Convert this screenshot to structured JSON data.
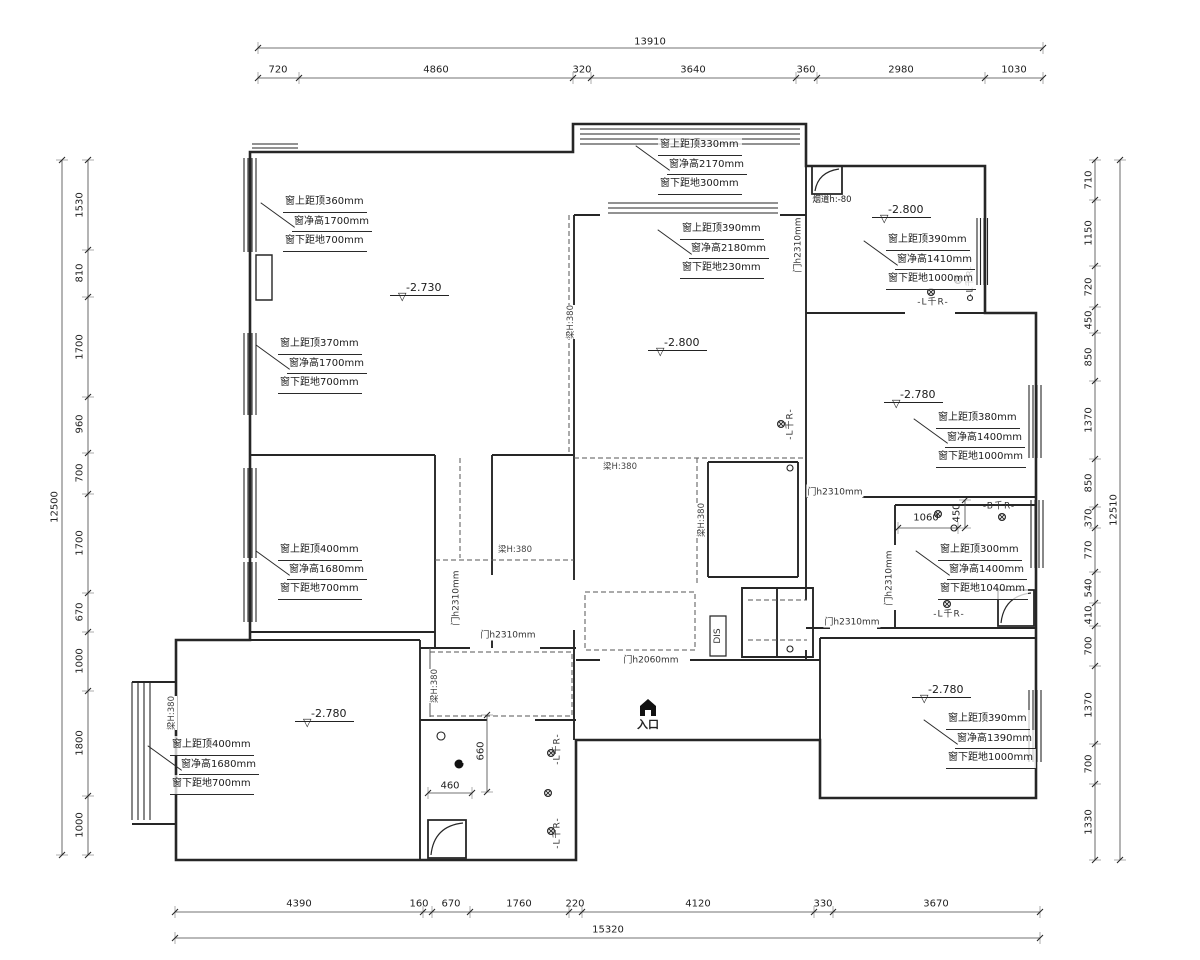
{
  "symbols": {
    "level_triangle": "▽",
    "entrance_label": "入口"
  },
  "labels": [
    {
      "t": "13910",
      "x": 650,
      "y": 42,
      "n": "dim-top-total"
    },
    {
      "t": "720",
      "x": 278,
      "y": 70,
      "n": "dim-top"
    },
    {
      "t": "4860",
      "x": 436,
      "y": 70,
      "n": "dim-top"
    },
    {
      "t": "320",
      "x": 582,
      "y": 70,
      "n": "dim-top"
    },
    {
      "t": "3640",
      "x": 693,
      "y": 70,
      "n": "dim-top"
    },
    {
      "t": "360",
      "x": 806,
      "y": 70,
      "n": "dim-top"
    },
    {
      "t": "2980",
      "x": 901,
      "y": 70,
      "n": "dim-top"
    },
    {
      "t": "1030",
      "x": 1014,
      "y": 70,
      "n": "dim-top"
    },
    {
      "t": "4390",
      "x": 299,
      "y": 904,
      "n": "dim-bottom"
    },
    {
      "t": "160",
      "x": 419,
      "y": 904,
      "n": "dim-bottom"
    },
    {
      "t": "670",
      "x": 451,
      "y": 904,
      "n": "dim-bottom"
    },
    {
      "t": "1760",
      "x": 519,
      "y": 904,
      "n": "dim-bottom"
    },
    {
      "t": "220",
      "x": 575,
      "y": 904,
      "n": "dim-bottom"
    },
    {
      "t": "4120",
      "x": 698,
      "y": 904,
      "n": "dim-bottom"
    },
    {
      "t": "330",
      "x": 823,
      "y": 904,
      "n": "dim-bottom"
    },
    {
      "t": "3670",
      "x": 936,
      "y": 904,
      "n": "dim-bottom"
    },
    {
      "t": "15320",
      "x": 608,
      "y": 930,
      "n": "dim-bottom-total"
    },
    {
      "t": "1530",
      "x": 80,
      "y": 205,
      "r": 1,
      "n": "dim-left"
    },
    {
      "t": "810",
      "x": 80,
      "y": 273,
      "r": 1,
      "n": "dim-left"
    },
    {
      "t": "1700",
      "x": 80,
      "y": 347,
      "r": 1,
      "n": "dim-left"
    },
    {
      "t": "960",
      "x": 80,
      "y": 424,
      "r": 1,
      "n": "dim-left"
    },
    {
      "t": "700",
      "x": 80,
      "y": 473,
      "r": 1,
      "n": "dim-left"
    },
    {
      "t": "1700",
      "x": 80,
      "y": 543,
      "r": 1,
      "n": "dim-left"
    },
    {
      "t": "670",
      "x": 80,
      "y": 612,
      "r": 1,
      "n": "dim-left"
    },
    {
      "t": "1000",
      "x": 80,
      "y": 661,
      "r": 1,
      "n": "dim-left"
    },
    {
      "t": "1800",
      "x": 80,
      "y": 743,
      "r": 1,
      "n": "dim-left"
    },
    {
      "t": "1000",
      "x": 80,
      "y": 825,
      "r": 1,
      "n": "dim-left"
    },
    {
      "t": "12500",
      "x": 55,
      "y": 507,
      "r": 1,
      "n": "dim-left-total"
    },
    {
      "t": "710",
      "x": 1089,
      "y": 180,
      "r": 1,
      "n": "dim-right"
    },
    {
      "t": "1150",
      "x": 1089,
      "y": 233,
      "r": 1,
      "n": "dim-right"
    },
    {
      "t": "720",
      "x": 1089,
      "y": 287,
      "r": 1,
      "n": "dim-right"
    },
    {
      "t": "450",
      "x": 1089,
      "y": 320,
      "r": 1,
      "n": "dim-right"
    },
    {
      "t": "850",
      "x": 1089,
      "y": 357,
      "r": 1,
      "n": "dim-right"
    },
    {
      "t": "1370",
      "x": 1089,
      "y": 420,
      "r": 1,
      "n": "dim-right"
    },
    {
      "t": "850",
      "x": 1089,
      "y": 483,
      "r": 1,
      "n": "dim-right"
    },
    {
      "t": "370",
      "x": 1089,
      "y": 518,
      "r": 1,
      "n": "dim-right"
    },
    {
      "t": "770",
      "x": 1089,
      "y": 550,
      "r": 1,
      "n": "dim-right"
    },
    {
      "t": "540",
      "x": 1089,
      "y": 588,
      "r": 1,
      "n": "dim-right"
    },
    {
      "t": "410",
      "x": 1089,
      "y": 615,
      "r": 1,
      "n": "dim-right"
    },
    {
      "t": "700",
      "x": 1089,
      "y": 646,
      "r": 1,
      "n": "dim-right"
    },
    {
      "t": "1370",
      "x": 1089,
      "y": 705,
      "r": 1,
      "n": "dim-right"
    },
    {
      "t": "700",
      "x": 1089,
      "y": 764,
      "r": 1,
      "n": "dim-right"
    },
    {
      "t": "1330",
      "x": 1089,
      "y": 822,
      "r": 1,
      "n": "dim-right"
    },
    {
      "t": "12510",
      "x": 1114,
      "y": 510,
      "r": 1,
      "n": "dim-right-total"
    },
    {
      "t": "1060",
      "x": 926,
      "y": 518,
      "n": "dim-inner"
    },
    {
      "t": "450",
      "x": 957,
      "y": 513,
      "r": 1,
      "n": "dim-inner"
    },
    {
      "t": "460",
      "x": 450,
      "y": 786,
      "n": "dim-inner"
    },
    {
      "t": "660",
      "x": 481,
      "y": 751,
      "r": 1,
      "n": "dim-inner"
    },
    {
      "t": "门h2310mm",
      "x": 797,
      "y": 245,
      "r": 1,
      "c": "door",
      "n": "door-height-label"
    },
    {
      "t": "门h2310mm",
      "x": 888,
      "y": 578,
      "r": 1,
      "c": "door",
      "n": "door-height-label"
    },
    {
      "t": "门h2310mm",
      "x": 455,
      "y": 598,
      "r": 1,
      "c": "door",
      "n": "door-height-label"
    },
    {
      "t": "门h2310mm",
      "x": 835,
      "y": 491,
      "c": "door",
      "n": "door-height-label"
    },
    {
      "t": "门h2310mm",
      "x": 852,
      "y": 621,
      "c": "door",
      "n": "door-height-label"
    },
    {
      "t": "门h2310mm",
      "x": 508,
      "y": 634,
      "c": "door",
      "n": "door-height-label"
    },
    {
      "t": "门h2060mm",
      "x": 651,
      "y": 659,
      "c": "door",
      "n": "door-height-label"
    },
    {
      "t": "梁H:380",
      "x": 570,
      "y": 322,
      "r": 1,
      "c": "beam",
      "n": "beam-label"
    },
    {
      "t": "梁H:380",
      "x": 620,
      "y": 466,
      "c": "beam",
      "n": "beam-label"
    },
    {
      "t": "梁H:380",
      "x": 701,
      "y": 520,
      "r": 1,
      "c": "beam",
      "n": "beam-label"
    },
    {
      "t": "梁H:380",
      "x": 434,
      "y": 686,
      "r": 1,
      "c": "beam",
      "n": "beam-label"
    },
    {
      "t": "梁H:380",
      "x": 515,
      "y": 549,
      "c": "beam",
      "n": "beam-label"
    },
    {
      "t": "梁H:380",
      "x": 171,
      "y": 713,
      "r": 1,
      "c": "beam",
      "n": "beam-label"
    },
    {
      "t": "-L千R-",
      "x": 933,
      "y": 301,
      "c": "drain",
      "n": "drain-label"
    },
    {
      "t": "-L千R-",
      "x": 969,
      "y": 281,
      "r": 1,
      "c": "drain",
      "n": "drain-label"
    },
    {
      "t": "-L千R-",
      "x": 789,
      "y": 424,
      "r": 1,
      "c": "drain",
      "n": "drain-label"
    },
    {
      "t": "-L千R-",
      "x": 949,
      "y": 613,
      "c": "drain",
      "n": "drain-label"
    },
    {
      "t": "-B千R-",
      "x": 999,
      "y": 505,
      "c": "drain",
      "n": "drain-label"
    },
    {
      "t": "-L千R-",
      "x": 556,
      "y": 749,
      "r": 1,
      "c": "drain",
      "n": "drain-label"
    },
    {
      "t": "-L千R-",
      "x": 556,
      "y": 833,
      "r": 1,
      "c": "drain",
      "n": "drain-label"
    },
    {
      "t": "烟道h:-80",
      "x": 832,
      "y": 199,
      "c": "sm",
      "n": "flue-label"
    },
    {
      "t": "DIS",
      "x": 718,
      "y": 636,
      "r": 1,
      "c": "door",
      "n": "dis-label"
    }
  ],
  "window_annotations": [
    {
      "x": 283,
      "y": 193,
      "lines": [
        "窗上距顶360mm",
        "窗净高1700mm",
        "窗下距地700mm"
      ]
    },
    {
      "x": 278,
      "y": 335,
      "lines": [
        "窗上距顶370mm",
        "窗净高1700mm",
        "窗下距地700mm"
      ]
    },
    {
      "x": 658,
      "y": 136,
      "lines": [
        "窗上距顶330mm",
        "窗净高2170mm",
        "窗下距地300mm"
      ]
    },
    {
      "x": 680,
      "y": 220,
      "lines": [
        "窗上距顶390mm",
        "窗净高2180mm",
        "窗下距地230mm"
      ]
    },
    {
      "x": 886,
      "y": 231,
      "lines": [
        "窗上距顶390mm",
        "窗净高1410mm",
        "窗下距地1000mm"
      ]
    },
    {
      "x": 936,
      "y": 409,
      "lines": [
        "窗上距顶380mm",
        "窗净高1400mm",
        "窗下距地1000mm"
      ]
    },
    {
      "x": 938,
      "y": 541,
      "lines": [
        "窗上距顶300mm",
        "窗净高1400mm",
        "窗下距地1040mm"
      ]
    },
    {
      "x": 946,
      "y": 710,
      "lines": [
        "窗上距顶390mm",
        "窗净高1390mm",
        "窗下距地1000mm"
      ]
    },
    {
      "x": 278,
      "y": 541,
      "lines": [
        "窗上距顶400mm",
        "窗净高1680mm",
        "窗下距地700mm"
      ]
    },
    {
      "x": 170,
      "y": 736,
      "lines": [
        "窗上距顶400mm",
        "窗净高1680mm",
        "窗下距地700mm"
      ]
    }
  ],
  "level_markers": [
    {
      "v": "-2.730",
      "x": 390,
      "y": 281
    },
    {
      "v": "-2.800",
      "x": 648,
      "y": 336
    },
    {
      "v": "-2.800",
      "x": 872,
      "y": 203
    },
    {
      "v": "-2.780",
      "x": 884,
      "y": 388
    },
    {
      "v": "-2.780",
      "x": 912,
      "y": 683
    },
    {
      "v": "-2.780",
      "x": 295,
      "y": 707
    }
  ]
}
